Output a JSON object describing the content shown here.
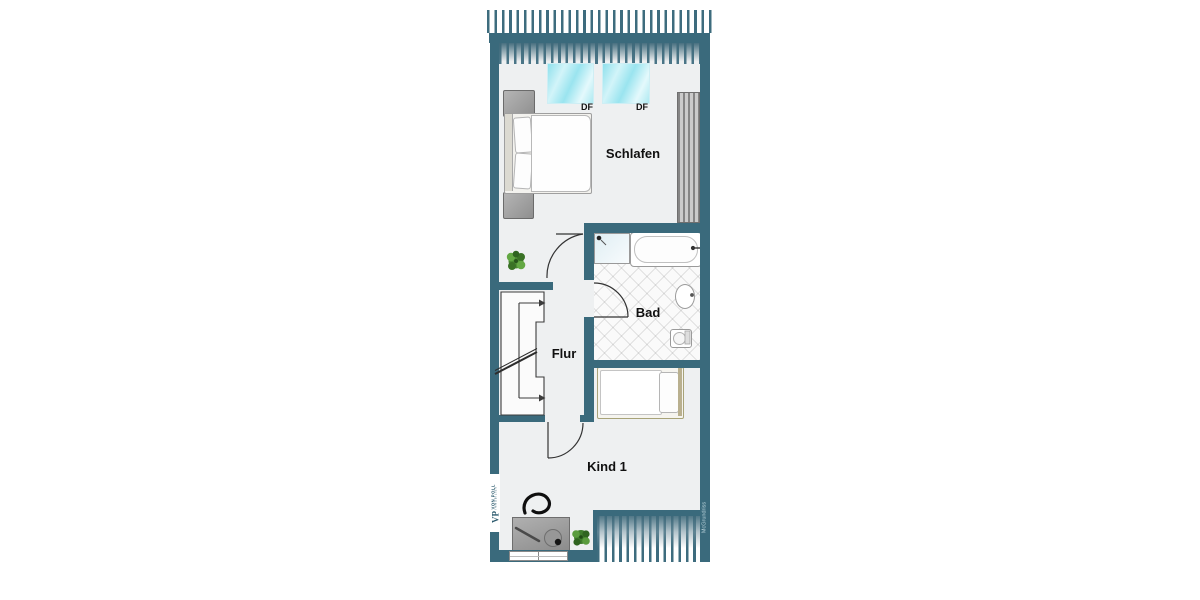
{
  "floorplan": {
    "rooms": {
      "schlafen": "Schlafen",
      "bad": "Bad",
      "flur": "Flur",
      "kind1": "Kind 1"
    },
    "skylights": {
      "df1": "DF",
      "df2": "DF"
    },
    "branding": {
      "logo_monogram": "VP",
      "logo_name": "VON POLL",
      "logo_sub": "IMMOBILIEN",
      "credit": "McGrundriss"
    },
    "colors": {
      "wall_teal": "#3a6a7c",
      "interior_gray": "#eef0f1",
      "skylight_cyan": "#9ae4ef",
      "plant_green": "#4b8c33",
      "label_black": "#101010"
    }
  }
}
